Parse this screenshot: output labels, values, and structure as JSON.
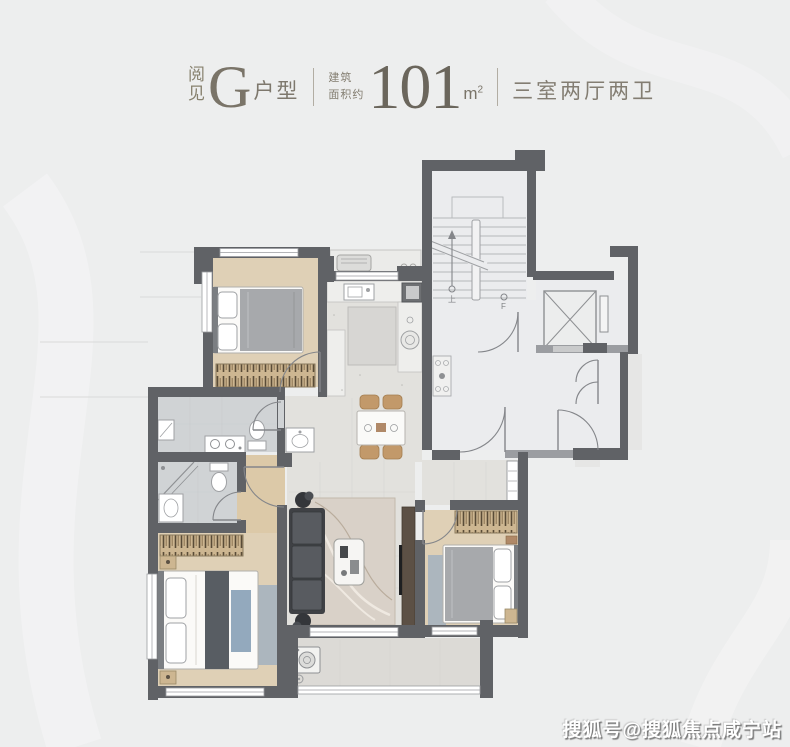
{
  "page": {
    "background_color": "#edeeee"
  },
  "header": {
    "brand_char_top": "阅",
    "brand_char_bottom": "见",
    "type_letter": "G",
    "type_suffix": "户型",
    "area_label_line1": "建筑",
    "area_label_line2": "面积约",
    "area_value": "101",
    "area_unit_base": "m",
    "area_unit_sup": "2",
    "layout_description": "三室两厅两卫",
    "text_color": "#7e786d"
  },
  "floorplan": {
    "labels": {
      "stairs_up": "上",
      "elevator_level": "F"
    },
    "colors": {
      "wall": "#606266",
      "wall_light": "#9b9da1",
      "wood_floor": "#dfd0b6",
      "tile_floor": "#d0d3d5",
      "living_floor": "#e2e1dd",
      "common_floor": "#ebecee",
      "balcony_floor": "#dcdad6",
      "wardrobe_tan": "#cdb691",
      "accent_blue": "#93a9bd",
      "bed_gray": "#a7a9ac",
      "sofa_dark": "#585b60"
    }
  },
  "watermark": {
    "text": "搜狐号@搜狐焦点咸宁站",
    "color": "#ffffff"
  }
}
